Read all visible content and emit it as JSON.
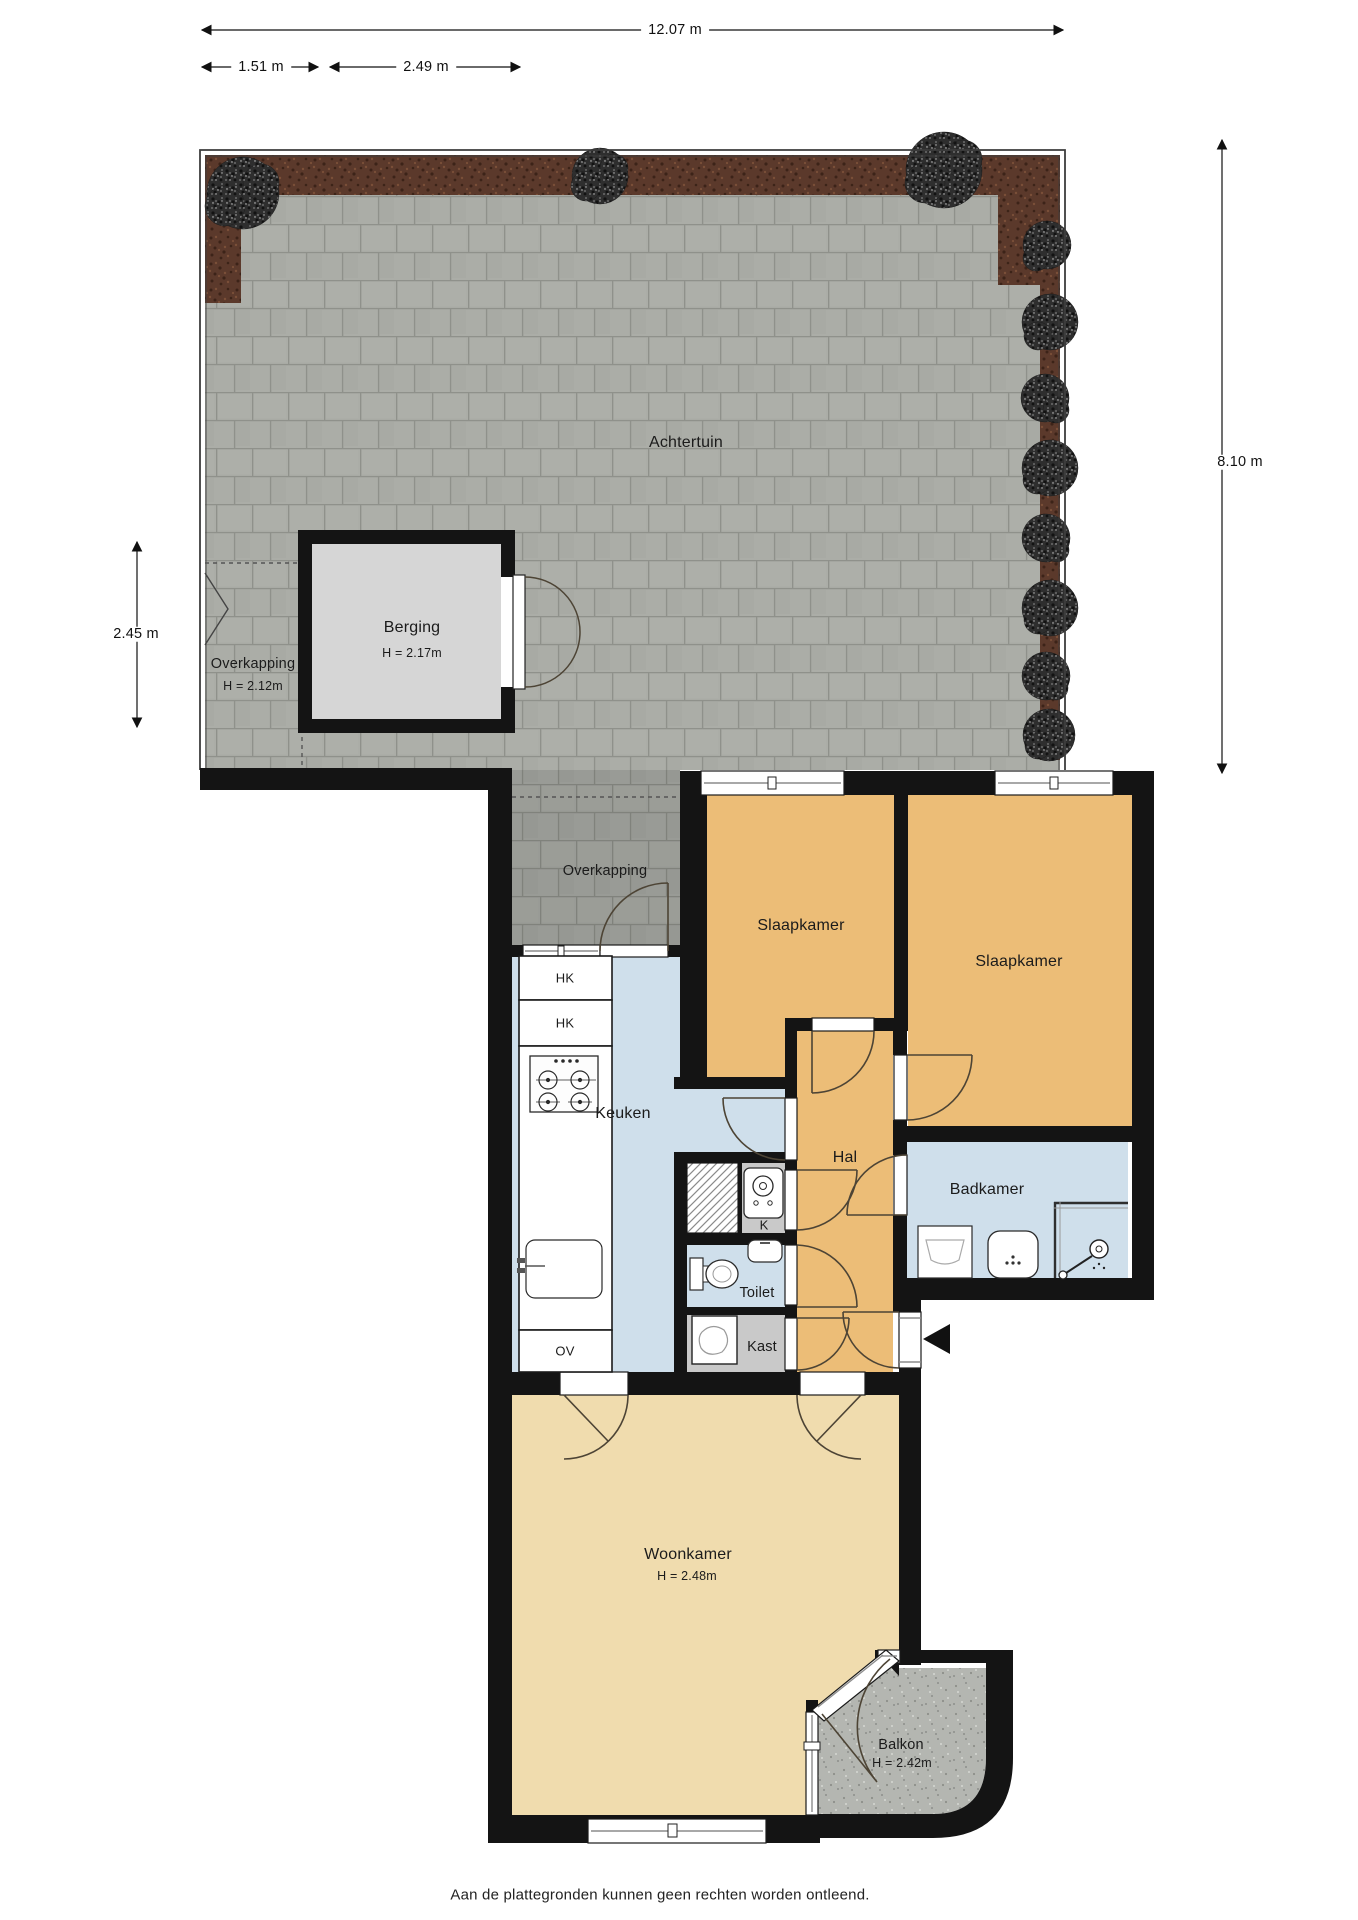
{
  "dimensions": {
    "total_width": "12.07 m",
    "overkapping_width": "1.51 m",
    "berging_width": "2.49 m",
    "overk": "",
    "overkapping_depth": "2.45 m",
    "garden_depth": "8.10 m"
  },
  "areas": {
    "garden": {
      "label": "Achtertuin"
    },
    "garden_overkapping": {
      "label": "Overkapping",
      "height": "H = 2.12m"
    },
    "berging": {
      "label": "Berging",
      "height": "H = 2.17m"
    },
    "house_overkapping": {
      "label": "Overkapping"
    },
    "bedroom_1": {
      "label": "Slaapkamer"
    },
    "bedroom_2": {
      "label": "Slaapkamer"
    },
    "kitchen": {
      "label": "Keuken"
    },
    "hall": {
      "label": "Hal"
    },
    "bathroom": {
      "label": "Badkamer"
    },
    "boiler_closet": {
      "label": "K"
    },
    "toilet": {
      "label": "Toilet"
    },
    "closet": {
      "label": "Kast"
    },
    "living_room": {
      "label": "Woonkamer",
      "height": "H = 2.48m"
    },
    "balcony": {
      "label": "Balkon",
      "height": "H = 2.42m"
    }
  },
  "kitchen_units": {
    "upper_cabinet_1": "HK",
    "upper_cabinet_2": "HK",
    "oven_unit": "OV"
  },
  "footer": "Aan de plattegronden kunnen geen rechten worden ontleend.",
  "colors": {
    "wall": "#141414",
    "room_orange": "#ecbd77",
    "room_blue": "#cfdfeb",
    "room_tan": "#f0dcae",
    "room_gray": "#c9c9c9",
    "berging_interior": "#d6d6d6",
    "tile_gray": "#abada7",
    "soil_brown": "#5b392b",
    "balcony_concrete": "#b4b6b1"
  }
}
